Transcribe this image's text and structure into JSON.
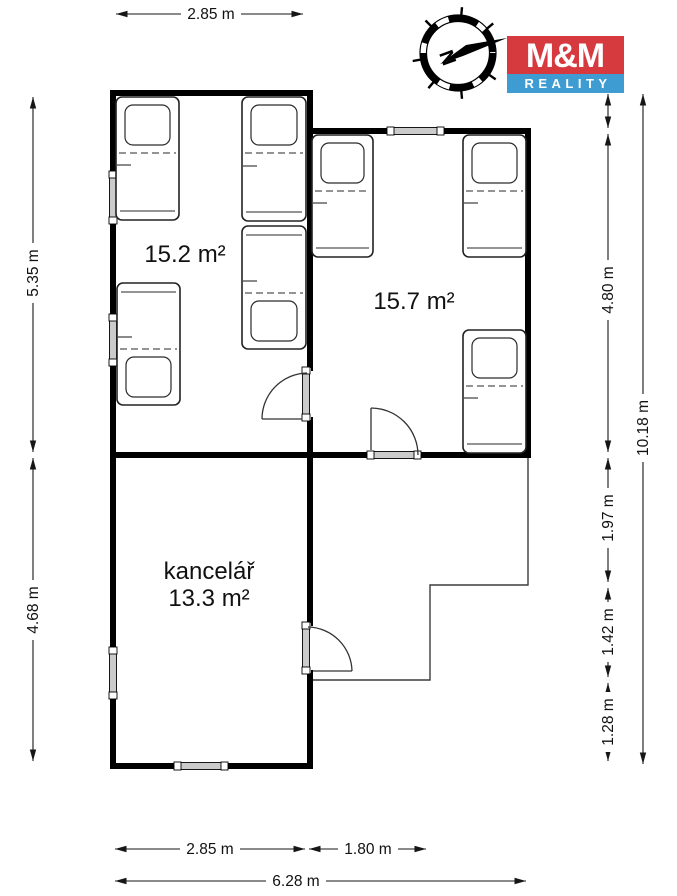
{
  "branding": {
    "logo_text_top": "M&M",
    "logo_text_bottom": "REALITY",
    "logo_red": "#d63a3f",
    "logo_blue": "#3e9cd2",
    "compass_north": "N"
  },
  "rooms": {
    "bedroom1": {
      "area_label": "15.2 m²"
    },
    "bedroom2": {
      "area_label": "15.7 m²"
    },
    "office": {
      "name": "kancelář",
      "area_label": "13.3 m²"
    }
  },
  "dimensions": {
    "top_width": "2.85 m",
    "left_upper_height": "5.35 m",
    "left_lower_height": "4.68 m",
    "right_bedroom2_height": "4.80 m",
    "right_annex_upper": "1.97 m",
    "right_annex_middle": "1.42 m",
    "right_annex_lower": "1.28 m",
    "right_total_height": "10.18 m",
    "bottom_office_width": "2.85 m",
    "bottom_annex_width": "1.80 m",
    "bottom_total_width": "6.28 m"
  }
}
